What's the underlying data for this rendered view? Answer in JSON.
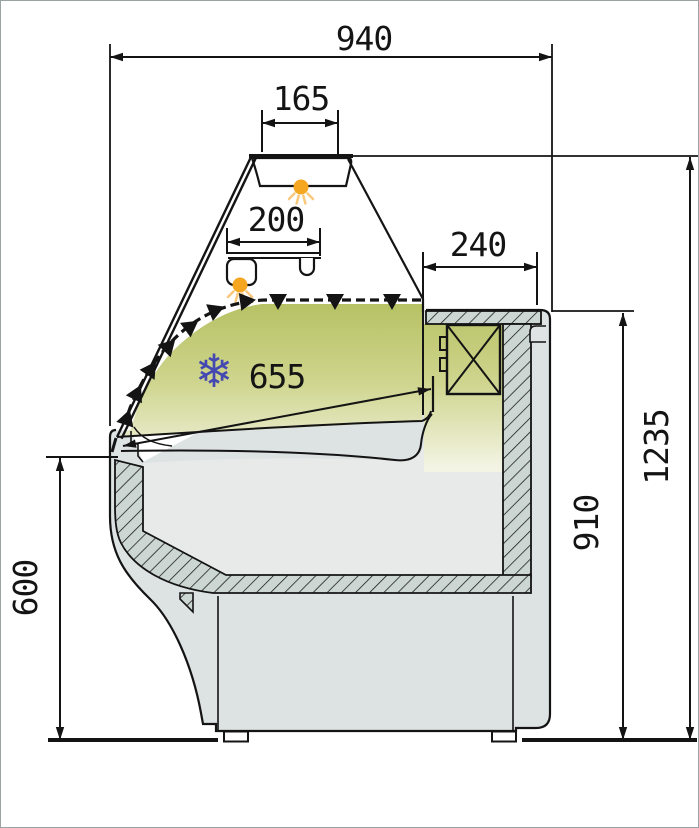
{
  "drawing": {
    "kind": "technical cross-section of refrigerated serve-over display counter",
    "dimensions": {
      "overall_depth": "940",
      "canopy": "165",
      "shelf": "200",
      "rear_counter": "240",
      "display_deck": "655",
      "overall_height": "1235",
      "rear_height": "910",
      "front_height": "600"
    },
    "icons": {
      "snowflake": "❄"
    },
    "colors": {
      "line": "#141414",
      "body_gray": "#dde2e2",
      "interior_gray": "#e7eae9",
      "hatch_fill": "#ccd6d2",
      "display_green_dark": "#b5c061",
      "display_green_mid": "#cfd58e",
      "display_green_light": "#f3f4e4",
      "lamp_orange": "#f5a722",
      "lamp_ray_orange": "#f9c87d",
      "snowflake_blue": "#4449b2"
    }
  }
}
